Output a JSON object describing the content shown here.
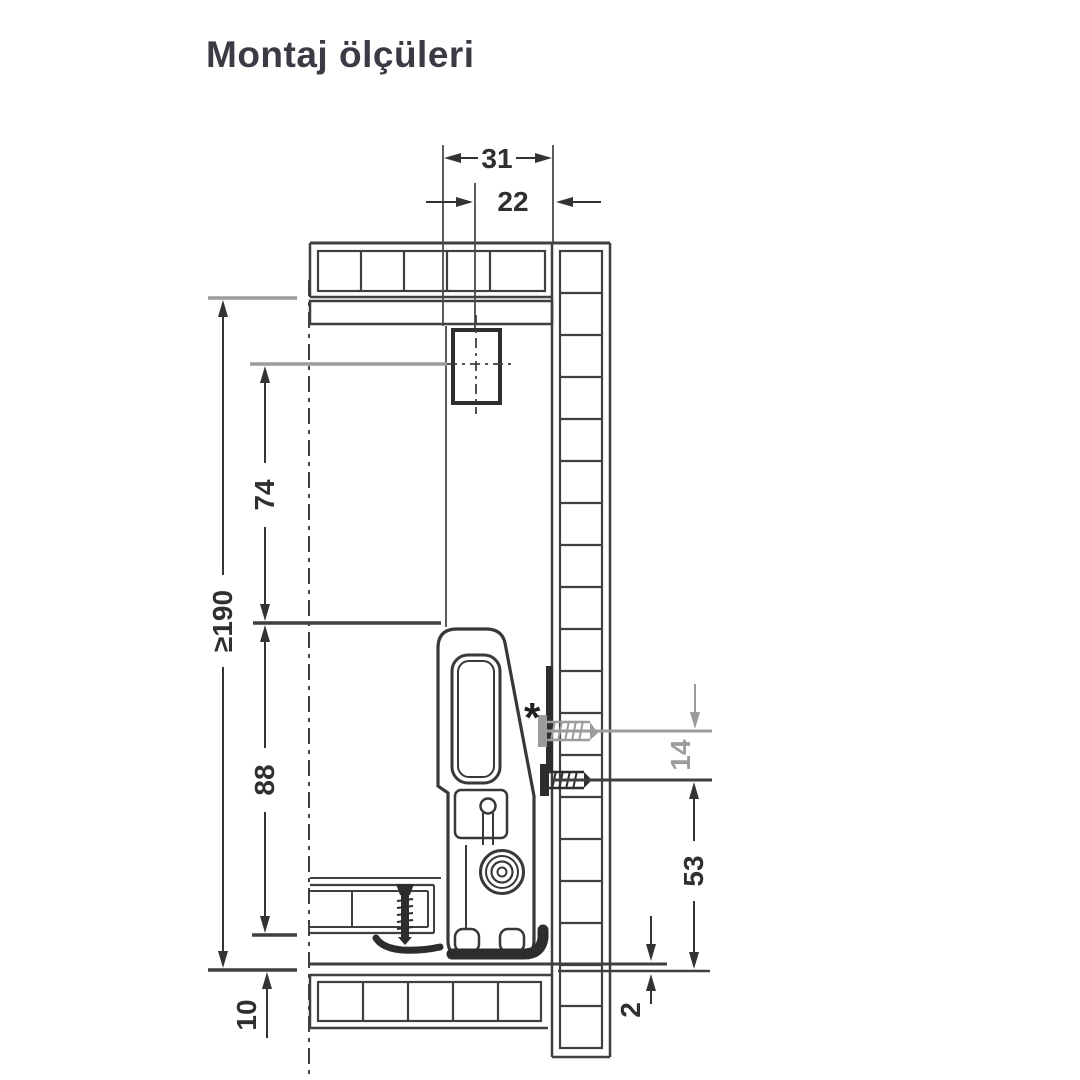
{
  "page": {
    "title": "Montaj ölçüleri",
    "background": "#ffffff"
  },
  "diagram": {
    "name": "drawer-slide-mounting-cross-section",
    "unit": "mm",
    "footnote_marker": "*",
    "dims": {
      "front_hole_offset": {
        "label": "31",
        "value": 31
      },
      "front_bracket_offset": {
        "label": "22",
        "value": 22
      },
      "min_inner_height": {
        "label": "≥190",
        "value": 190,
        "minimum": true
      },
      "bracket_to_side_top": {
        "label": "74",
        "value": 74
      },
      "side_profile_height": {
        "label": "88",
        "value": 88
      },
      "runner_bottom_offset": {
        "label": "10",
        "value": 10
      },
      "hole_pitch": {
        "label": "14",
        "value": 14,
        "alternate_position": true
      },
      "rear_hole_height": {
        "label": "53",
        "value": 53
      },
      "bottom_clearance": {
        "label": "2",
        "value": 2
      }
    },
    "colors": {
      "line": "#3f3f3f",
      "alt_gray": "#9c9c9c",
      "dark_fill": "#2d2d2d",
      "title_text": "#3b3b45"
    }
  }
}
